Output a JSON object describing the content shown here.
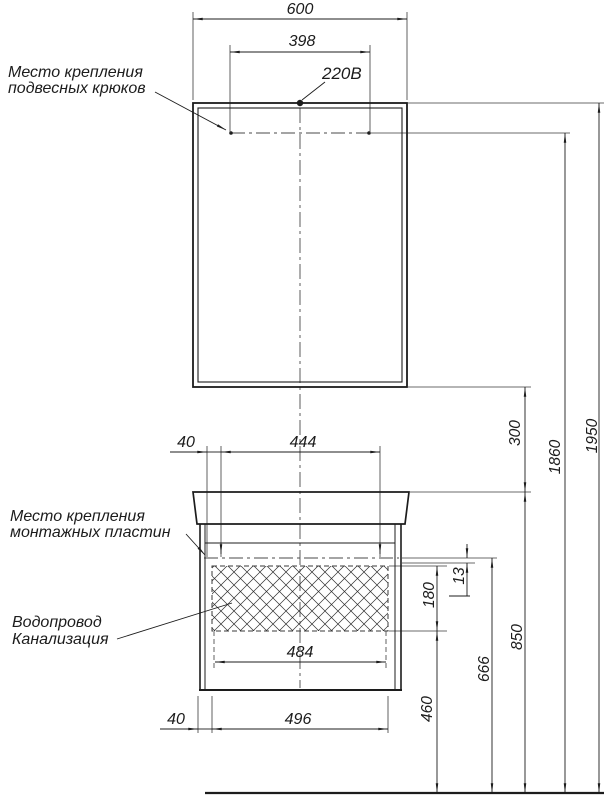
{
  "drawing": {
    "type": "installation-scheme",
    "labels": {
      "hooks_line1": "Место крепления",
      "hooks_line2": "подвесных крюков",
      "plates_line1": "Место крепления",
      "plates_line2": "монтажных пластин",
      "water": "Водопровод",
      "sewer": "Канализация",
      "power": "220В"
    },
    "dimensions": {
      "mirror_width": "600",
      "hooks_span": "398",
      "plate_offset_top": "40",
      "plates_span": "444",
      "mirror_to_counter_gap": "300",
      "total_height": "1950",
      "hooks_height": "1860",
      "plate_gap": "13",
      "service_zone_height": "180",
      "counter_height": "850",
      "plates_height": "666",
      "service_zone_bottom_height": "460",
      "service_zone_width": "484",
      "recess_offset_bottom": "40",
      "recess_width": "496"
    },
    "colors": {
      "line": "#1c1c1c",
      "thin_line": "#3a3a3a",
      "background": "#ffffff"
    }
  }
}
